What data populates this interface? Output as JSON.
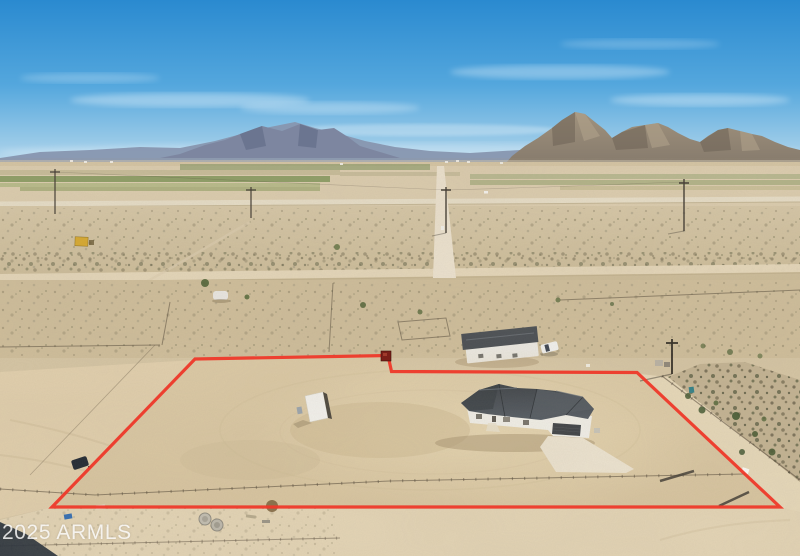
{
  "watermark": {
    "text": "2025 ARMLS"
  },
  "scene": {
    "type": "aerial-drone-photo",
    "description": "Aerial view of a new single-story home with gray roof on a graded desert lot outlined by a red property boundary, desert mountains, farm fields and dirt roads on the horizon",
    "property_boundary_color": "#ee392a",
    "colors": {
      "sky_top": "#2a8ad0",
      "sky_mid": "#54a7dd",
      "sky_low": "#9ccbe8",
      "sky_horizon": "#cbe4f2",
      "mountain_far": "#8796af",
      "mountain_rock": "#8d8170",
      "desert_base": "#d5c5a4",
      "desert_light": "#e1d0ae",
      "field_green": "#7f9458",
      "roof_gray": "#42474e",
      "house_white": "#f1efe8",
      "driveway": "#ece3d0",
      "shed_white": "#f4f3ef",
      "shed_yellow": "#d8a92c",
      "shadow_dark": "#232c38"
    },
    "objects": [
      "blue sky with wispy clouds",
      "distant hazy mountain ridge",
      "rocky desert mountain ranges",
      "green irrigated farm strips",
      "horizon road",
      "receding dirt road",
      "utility poles",
      "yellow shed on neighbor lot",
      "white rv trailer",
      "neighbor house with white pickup truck",
      "red property boundary outline with jog and dark bin marker",
      "graded dirt lot",
      "small white storage shed",
      "new single-story house with dark gray hip roof",
      "concrete driveway",
      "interior rail fencing and gate panels",
      "dirt roads bordering parcel",
      "desert scrub and green trees",
      "concrete septic cylinders and debris",
      "dark shadow in bottom-left corner"
    ]
  }
}
